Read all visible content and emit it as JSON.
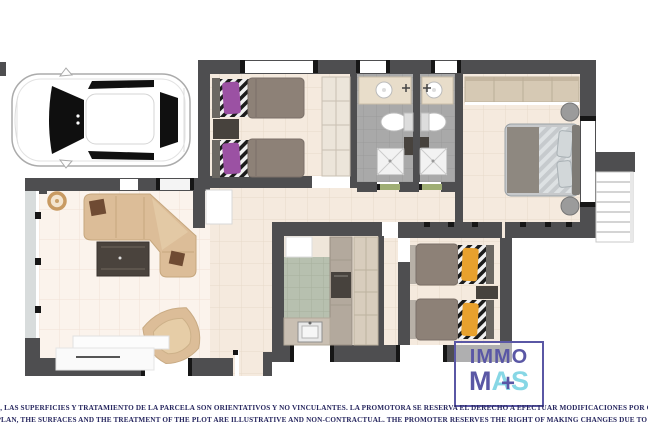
{
  "logo": {
    "top": "IMMO",
    "m": "M",
    "a": "A",
    "s": "S",
    "plus": "+"
  },
  "disclaimer": {
    "line_es": "ESTE PLANO ARTISTICO, LAS SUPERFICIES Y TRATAMIENTO DE LA PARCELA SON ORIENTATIVOS Y NO VINCULANTES. LA PROMOTORA SE RESERVA EL DERECHO A EFECTUAR MODIFICACIONES POR CUALQUIER NECESIDAD",
    "line_en": "THIS ARTISTIC PLAN, THE SURFACES AND THE TREATMENT OF THE PLOT ARE ILLUSTRATIVE AND NON-CONTRACTUAL. THE PROMOTER RESERVES THE RIGHT OF MAKING CHANGES DUE TO ANY NECESSITY"
  },
  "colors": {
    "wall_color": "#4e4e50",
    "floor_beige": "#f5eade",
    "floor_living": "#fbf3ec",
    "bath_tile": "#a9a9a9",
    "kitchen_tile": "#b7c0af",
    "sofa_beige": "#dcbd98",
    "pillow_purple": "#9b51a3",
    "pillow_orange": "#e8a12e",
    "blanket_gray": "#8d8177",
    "logo_purple": "#5a57a5",
    "logo_cyan": "#87d7e5",
    "disclaimer_navy": "#27275f"
  },
  "scene": {
    "type": "apartment-floor-plan-render",
    "elements": [
      "car-top-view",
      "living-room",
      "kitchen",
      "hallway",
      "twin-bedroom-purple",
      "twin-bedroom-orange",
      "master-bedroom",
      "bathroom-1",
      "bathroom-2",
      "staircase",
      "terrace"
    ]
  }
}
